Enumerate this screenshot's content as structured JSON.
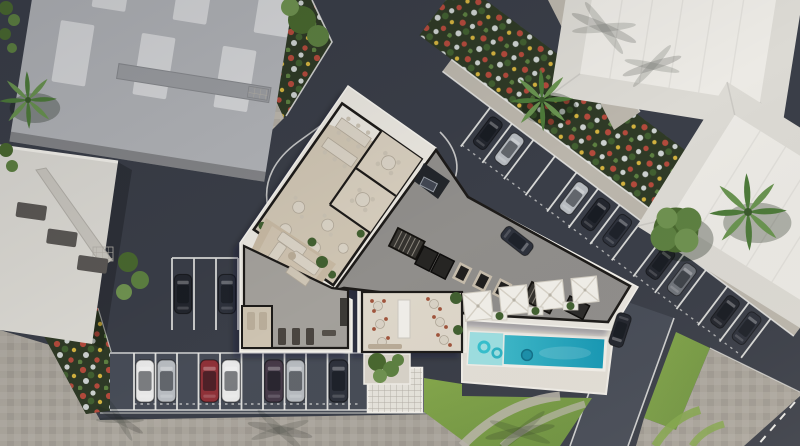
{
  "scene": {
    "title": "Aerial 3D architectural site-plan render: apartment building ground-floor cutaway with pool, parking and landscaping",
    "view": "top-down aerial render",
    "visible_text": "none"
  },
  "palette": {
    "asphalt": "#3a3e48",
    "asphalt-light": "#474c57",
    "paver": "#a9a49b",
    "paver-light": "#bbb6ac",
    "line": "#e9e9e6",
    "roof-gray": "#b1b3b7",
    "roof-panel": "#d6d7d9",
    "roof-white": "#dcdad4",
    "roof-white-lit": "#eceae5",
    "building-white": "#e9e6df",
    "wall": "#1d1b19",
    "floor-beige": "#cfc5b3",
    "floor-light": "#ded7ca",
    "floor-gray": "#908e8b",
    "floor-gym": "#a3a09b",
    "carpet": "#c6b8a2",
    "furn": "#d9d2c5",
    "furn-edge": "#b0a798",
    "chair": "#c9c1b2",
    "chair-red": "#a0543c",
    "deck": "#e3dfd7",
    "pool-shallow": "#9edfe2",
    "pool-mid": "#49c2cf",
    "pool-deep": "#1598b5",
    "pool-rim": "#f2efe9",
    "lawn": "#84a74b",
    "lawn-dark": "#6d9140",
    "bed-soil": "#2f3a26",
    "flower-red": "#b34a3c",
    "flower-white": "#ccd1cf",
    "flower-yellow": "#d3b23f",
    "shrub": "#426031",
    "tree-1": "#49682f",
    "tree-2": "#5d8041",
    "tree-3": "#6f9250",
    "palm-1": "#4d7a3a",
    "palm-2": "#699350",
    "umbrella": "#f1efe9",
    "lounger": "#979ba1",
    "car-white": "#e8e8e8",
    "car-silver": "#b7bbc0",
    "car-gray": "#70747b",
    "car-dark": "#23262e",
    "car-dark2": "#2e323c",
    "car-red": "#8e3138",
    "car-purple": "#463a49",
    "grid-structure": "#e6e3dc",
    "shadow": "rgba(15,17,22,0.28)"
  },
  "objects": {
    "neighbor_buildings": [
      "northwest-gray-roof-with-skylights",
      "west-white-roof-with-slots",
      "northeast-white-hip-roof",
      "east-white-hip-roof"
    ],
    "main_building_areas": [
      "coworking-restaurant-wing",
      "meeting-rooms",
      "lobby-lounge",
      "gym-spa",
      "corridor-and-cores",
      "elevators",
      "stairs",
      "dining-terrace-room",
      "entrance-porch"
    ],
    "amenities": {
      "pool": 1,
      "pool_floats": 3,
      "umbrellas": 4,
      "sun_loungers": 5,
      "lawn_areas": 2,
      "roof_grid_skylight": 1
    },
    "vegetation": {
      "palm_trees": 3,
      "leafy_trees": 2,
      "flower_beds": 3,
      "hedges": 2
    },
    "parking": {
      "east_diagonal_row_cars": 9,
      "south_row_cars": 7,
      "west_block_cars": 2,
      "roadside_cars": 2,
      "total_cars": 20
    },
    "roads": [
      "north-driveway-with-loop-markings",
      "east-access-road",
      "south-paver-promenade",
      "corner-street-with-dashed-line"
    ]
  }
}
